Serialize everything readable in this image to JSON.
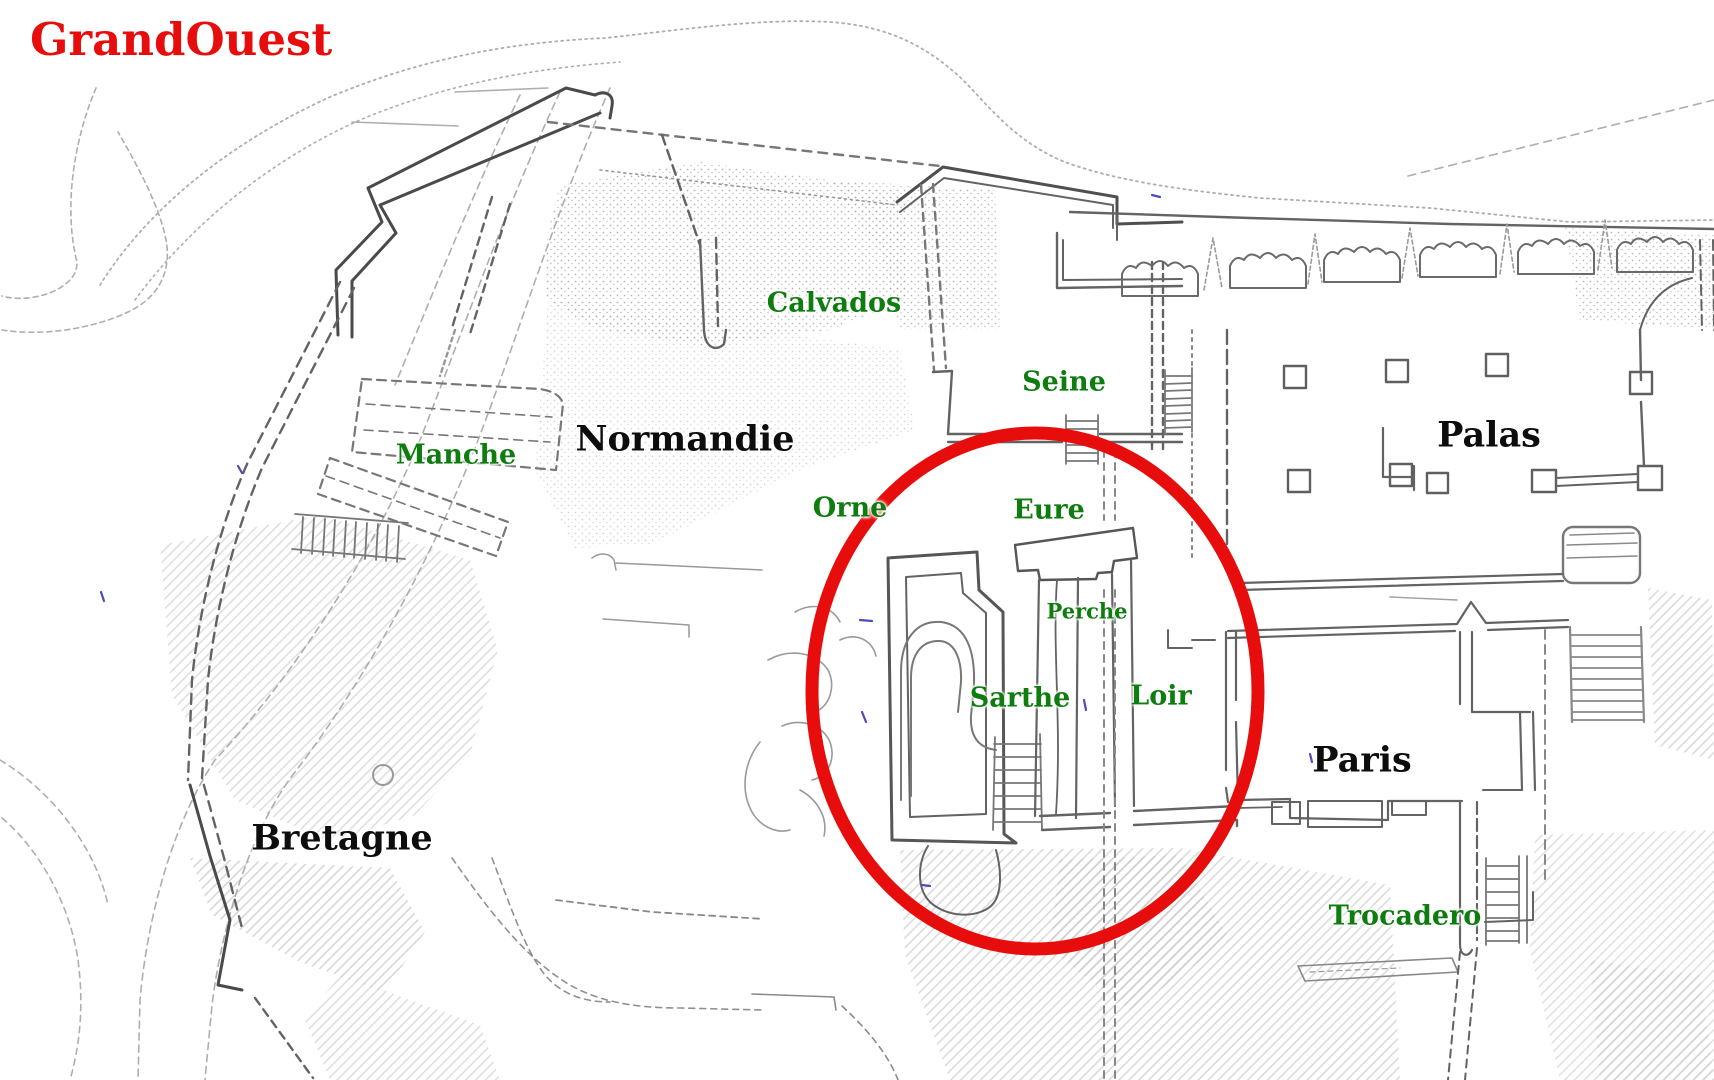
{
  "title": {
    "text": "GrandOuest",
    "color": "#e80d0d"
  },
  "colors": {
    "highlight_red": "#e80d0d",
    "place_green": "#0e7c0e",
    "area_black": "#0d0d0d",
    "plan_line_gray": "#6b6b6b",
    "background": "#ffffff"
  },
  "map": {
    "kind": "hand-drawn site plan",
    "areas": {
      "normandie": {
        "text": "Normandie",
        "color": "#0d0d0d"
      },
      "bretagne": {
        "text": "Bretagne",
        "color": "#0d0d0d"
      },
      "palas": {
        "text": "Palas",
        "color": "#0d0d0d"
      },
      "paris": {
        "text": "Paris",
        "color": "#0d0d0d"
      }
    },
    "places": {
      "calvados": {
        "text": "Calvados",
        "color": "#0e7c0e"
      },
      "seine": {
        "text": "Seine",
        "color": "#0e7c0e"
      },
      "manche": {
        "text": "Manche",
        "color": "#0e7c0e"
      },
      "orne": {
        "text": "Orne",
        "color": "#0e7c0e"
      },
      "eure": {
        "text": "Eure",
        "color": "#0e7c0e"
      },
      "perche": {
        "text": "Perche",
        "color": "#0e7c0e"
      },
      "sarthe": {
        "text": "Sarthe",
        "color": "#0e7c0e"
      },
      "loir": {
        "text": "Loir",
        "color": "#0e7c0e"
      },
      "trocadero": {
        "text": "Trocadero",
        "color": "#0e7c0e"
      }
    },
    "highlight": {
      "shape": "ellipse",
      "color": "#e80d0d",
      "encircles": [
        "Eure",
        "Perche",
        "Sarthe",
        "Loir"
      ]
    }
  }
}
